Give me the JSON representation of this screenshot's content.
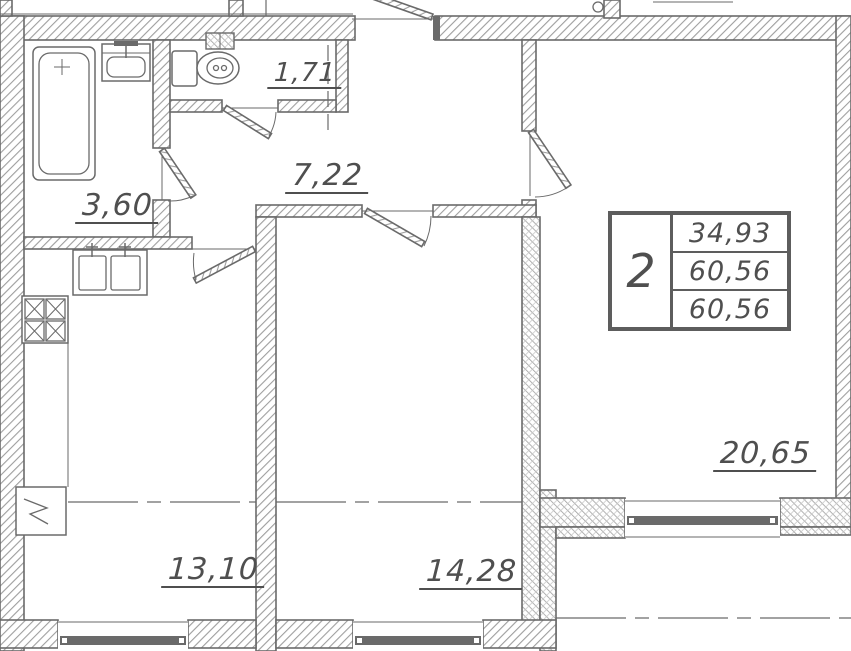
{
  "plan": {
    "type": "apartment-floor-plan",
    "rooms": {
      "bathroom": {
        "area": "3,60"
      },
      "wc": {
        "area": "1,71"
      },
      "hallway": {
        "area": "7,22"
      },
      "kitchen": {
        "area": "13,10"
      },
      "bedroom": {
        "area": "14,28"
      },
      "living": {
        "area": "20,65"
      }
    },
    "stamp": {
      "number": "2",
      "values": [
        "34,93",
        "60,56",
        "60,56"
      ]
    },
    "fixtures": [
      "bathtub",
      "wash-basin",
      "toilet",
      "vent-box",
      "kitchen-sink",
      "stove",
      "refrigerator"
    ],
    "colors": {
      "wall_line": "#6a6a6a",
      "hatch": "#9e9e9e",
      "text": "#4f4f4f",
      "background": "#ffffff"
    }
  }
}
